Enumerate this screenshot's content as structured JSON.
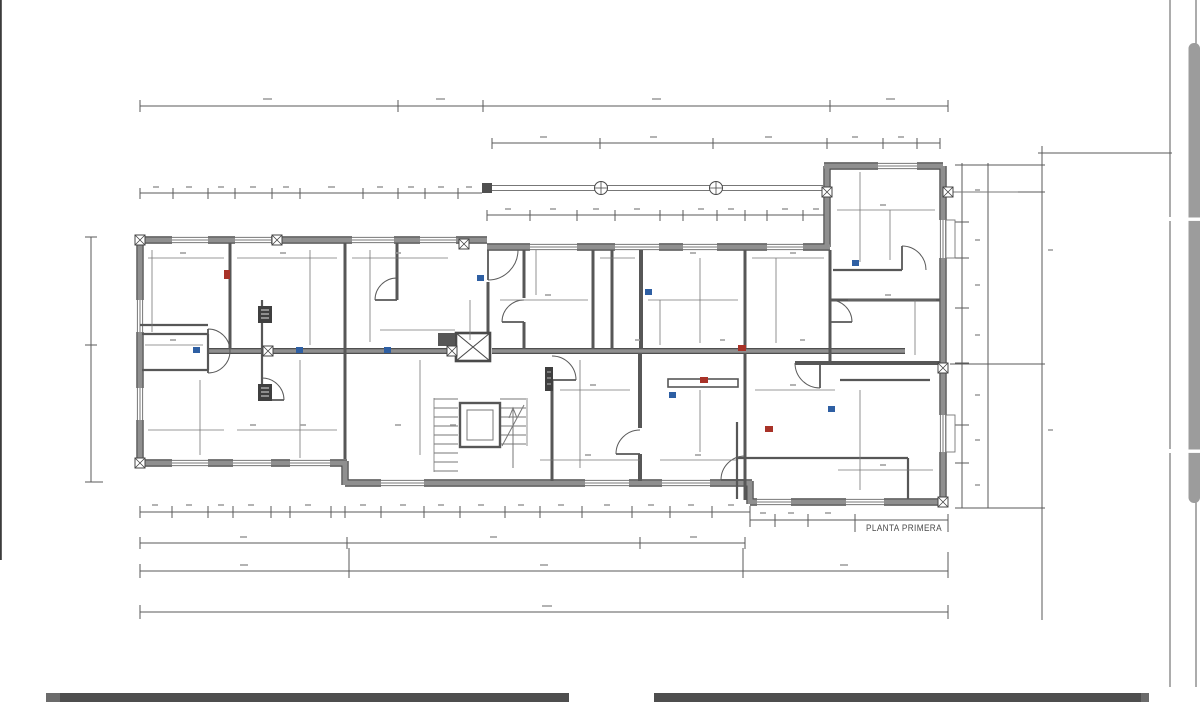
{
  "drawing": {
    "title_label": "PLANTA PRIMERA",
    "type_note": "architectural floor plan sheet"
  },
  "icons": [
    "elevator-shaft-icon",
    "stair-flight-icon",
    "stair-direction-arrow-icon",
    "column-tie-icon",
    "wall-bolt-icon",
    "electrical-panel-icon"
  ],
  "markers": {
    "red_count": 4,
    "blue_count": 8
  },
  "viewer": {
    "scrollbar_present": true,
    "bottom_bars": 2
  },
  "colors": {
    "wall": "#8f8f8f",
    "wall_edge": "#4f4f4f",
    "partition": "#575757",
    "thin": "#777777",
    "dim": "#5a5a5a",
    "smudge": "#9a9a9a",
    "accent_red": "#a83228",
    "accent_blue": "#2e5fa3",
    "scrollbar": "#9c9c9c",
    "bottom_bar": "#4e4e4e",
    "edge_line": "#3c3c3c",
    "label": "#4a4a4a",
    "panel": "#3f3f3f",
    "bg": "#ffffff"
  }
}
